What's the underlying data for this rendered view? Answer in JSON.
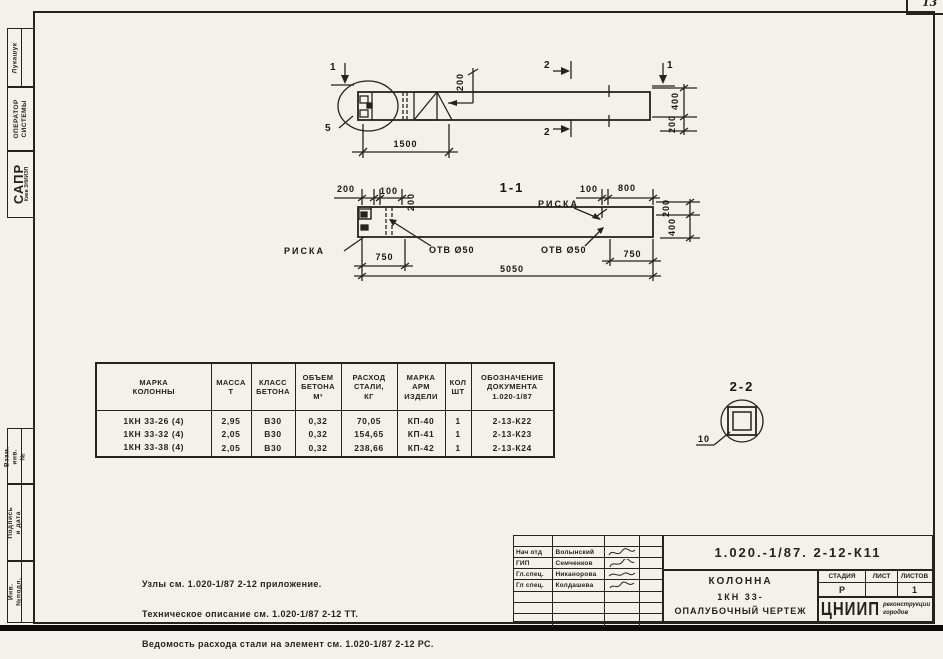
{
  "page_number": "13",
  "sidebar": {
    "author": "Лукашук",
    "operator": "ОПЕРАТОР\nСИСТЕМЫ",
    "org": "САПР",
    "org_sub": "Киев ЗНИИЭП",
    "stamp_vzam": "Взам. инв. №",
    "stamp_sign_date": "Подпись и дата",
    "stamp_inv": "Инв. №подл."
  },
  "elevation": {
    "marker1": "1",
    "marker2": "2",
    "detail_ref": "5",
    "d1500": "1500",
    "d200": "200",
    "d400": "400"
  },
  "section11": {
    "title": "1-1",
    "d200": "200",
    "d100": "100",
    "d800": "800",
    "d400": "400",
    "d750": "750",
    "d5050": "5050",
    "riska": "РИСКА",
    "hole": "ОТВ Ø50"
  },
  "section22": {
    "title": "2-2",
    "wall": "10"
  },
  "table": {
    "headers": [
      "МАРКА\nКОЛОННЫ",
      "МАССА\nТ",
      "КЛАСС\nБЕТОНА",
      "ОБЪЕМ\nБЕТОНА\nМ³",
      "РАСХОД\nСТАЛИ,\nКГ",
      "МАРКА\nАРМ\nИЗДЕЛИ",
      "КОЛ\nШТ",
      "ОБОЗНАЧЕНИЕ\nДОКУМЕНТА\n1.020-1/87"
    ],
    "rows": [
      [
        "1КН 33-26 (4)",
        "2,95",
        "В30",
        "0,32",
        "70,05",
        "КП-40",
        "1",
        "2-13-К22"
      ],
      [
        "1КН 33-32 (4)",
        "2,05",
        "В30",
        "0,32",
        "154,65",
        "КП-41",
        "1",
        "2-13-К23"
      ],
      [
        "1КН 33-38 (4)",
        "2,05",
        "В30",
        "0,32",
        "238,66",
        "КП-42",
        "1",
        "2-13-К24"
      ]
    ]
  },
  "notes": {
    "line1": "Узлы см. 1.020-1/87 2-12 приложение.",
    "line2": "Техническое описание см. 1.020-1/87 2-12 ТТ.",
    "line3": "Ведомость расхода стали на элемент см. 1.020-1/87 2-12 РС."
  },
  "title_block": {
    "doc_number": "1.020.-1/87. 2-12-К11",
    "signers": [
      {
        "role": "Нач отд",
        "name": "Волынский"
      },
      {
        "role": "ГИП",
        "name": "Семченков"
      },
      {
        "role": "Гл.спец.",
        "name": "Никанорова"
      },
      {
        "role": "Гл спец.",
        "name": "Колдашева"
      }
    ],
    "object_line1": "КОЛОННА",
    "object_line2": "1КН 33-",
    "object_line3": "ОПАЛУБОЧНЫЙ ЧЕРТЕЖ",
    "stage_label": "СТАДИЯ",
    "sheet_label": "ЛИСТ",
    "sheets_label": "ЛИСТОВ",
    "stage": "Р",
    "sheets_total": "1",
    "org_abbr": "ЦНИИП",
    "org_name": "реконструкции\nгородов"
  }
}
